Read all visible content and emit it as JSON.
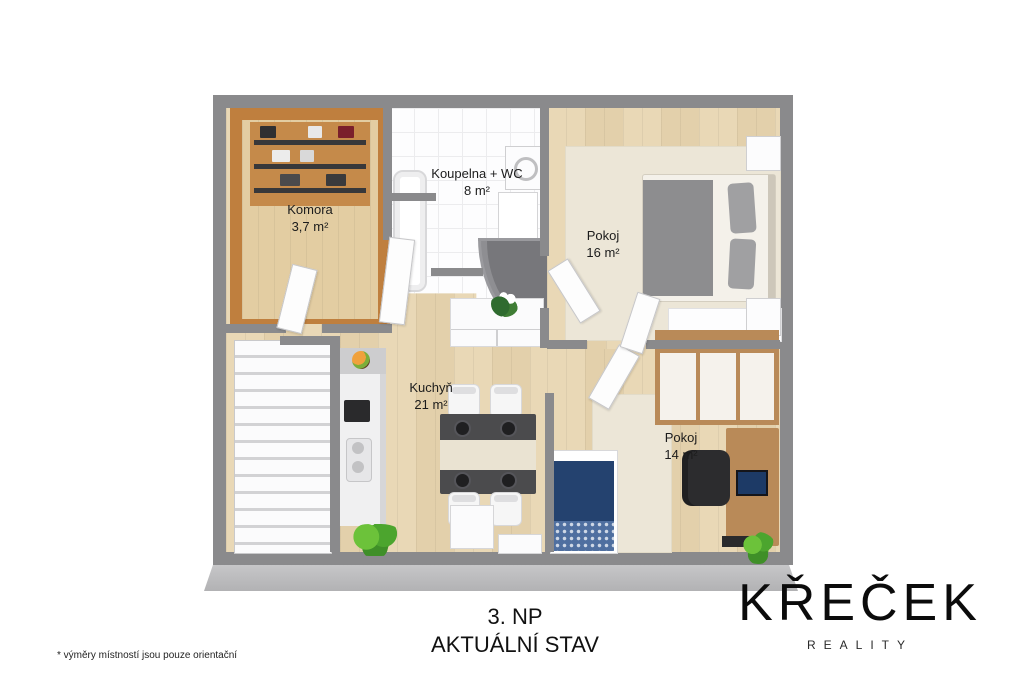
{
  "rooms": {
    "komora": {
      "name": "Komora",
      "area": "3,7 m²"
    },
    "koupelna": {
      "name": "Koupelna + WC",
      "area": "8 m²"
    },
    "pokoj16": {
      "name": "Pokoj",
      "area": "16 m²"
    },
    "kuchyn": {
      "name": "Kuchyň",
      "area": "21 m²"
    },
    "pokoj14": {
      "name": "Pokoj",
      "area": "14 m²"
    }
  },
  "footer": {
    "floor_label": "3. NP",
    "status_label": "AKTUÁLNÍ STAV",
    "disclaimer": "*  výměry místností jsou pouze orientační"
  },
  "brand": {
    "name": "KŘEČEK",
    "subtitle": "REALITY"
  },
  "colors": {
    "wall": "#8a8a8c",
    "wall_front_face": "#bcbcbe",
    "wood_floor": "#e9d8b6",
    "komora_wood": "#bf7f3e",
    "tile": "#fdfdfe",
    "rug": "#ece6d7",
    "bed_gray": "#8d8d8f",
    "bed_blue": "#24426f",
    "desk_wood": "#b98a58",
    "table_dark": "#4b4b4d",
    "plant_green": "#58b033"
  }
}
